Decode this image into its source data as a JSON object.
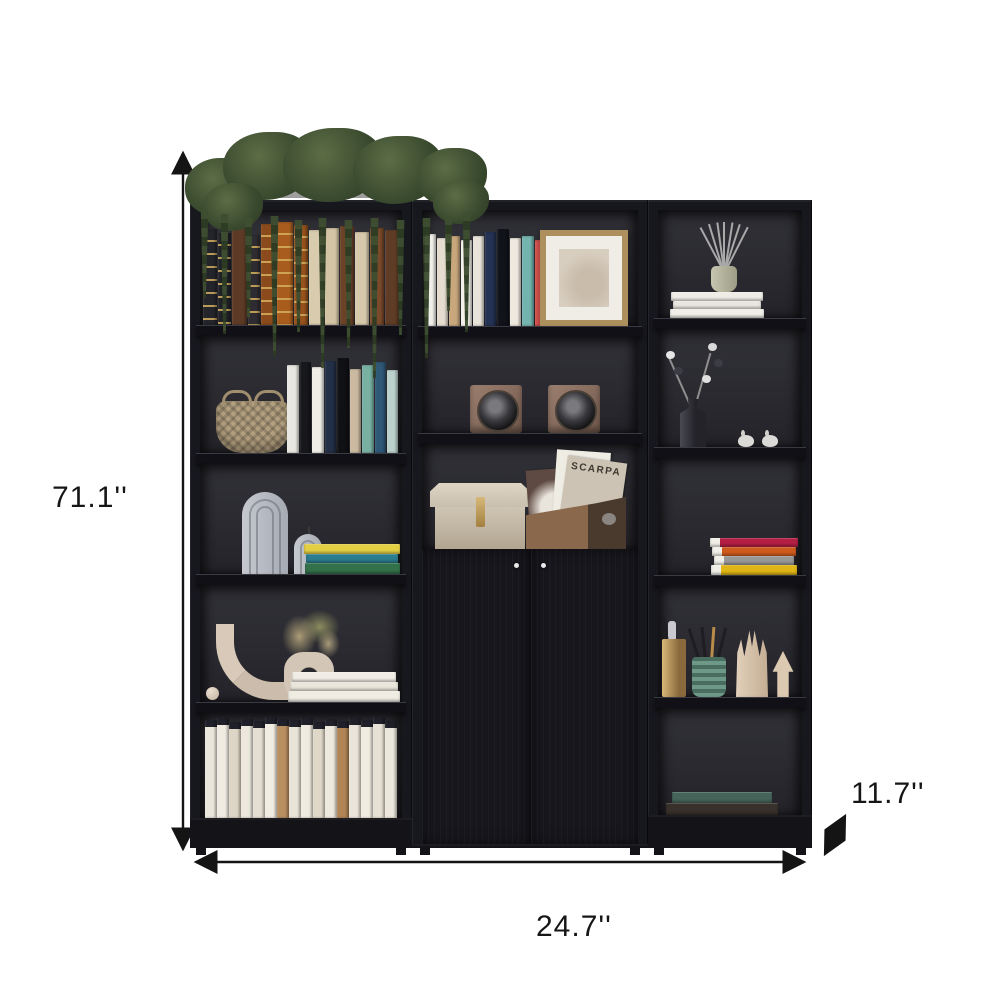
{
  "dimensions": {
    "height_label": "71.1''",
    "width_label": "24.7''",
    "depth_label": "11.7''"
  },
  "decor": {
    "magazine_label": "SCARPA"
  },
  "palette": {
    "background": "#ffffff",
    "frame": "#17171e",
    "interior": "#2b2b31",
    "shelf": "#101016",
    "annotation": "#161616",
    "planter": "#b9b9b9",
    "plant_green": "#44543a",
    "speaker_bronze": "#8d7468",
    "frame_gold": "#ad905e"
  },
  "books": {
    "left_row1": [
      {
        "c": "#23252b",
        "h": 96,
        "w": 14,
        "cls": "bands"
      },
      {
        "c": "#1f2127",
        "h": 92,
        "w": 13,
        "cls": "bands"
      },
      {
        "c": "#5d3a26",
        "h": 100,
        "w": 15
      },
      {
        "c": "#2e2c30",
        "h": 90,
        "w": 12,
        "cls": "bands"
      },
      {
        "c": "#8a4a1c",
        "h": 101,
        "w": 15,
        "cls": "bands"
      },
      {
        "c": "#a85c1e",
        "h": 103,
        "w": 16,
        "cls": "bands"
      },
      {
        "c": "#96521c",
        "h": 100,
        "w": 14,
        "cls": "bands"
      },
      {
        "c": "#d8cbae",
        "h": 95,
        "w": 15
      },
      {
        "c": "#d2c4a4",
        "h": 97,
        "w": 14
      },
      {
        "c": "#6b4227",
        "h": 99,
        "w": 14
      },
      {
        "c": "#d6c9ab",
        "h": 93,
        "w": 14
      },
      {
        "c": "#7a4a2a",
        "h": 97,
        "w": 14
      },
      {
        "c": "#5f3c25",
        "h": 95,
        "w": 14
      }
    ],
    "left_row2": [
      {
        "c": "#e9e7e1",
        "h": 88,
        "w": 12
      },
      {
        "c": "#17181c",
        "h": 91,
        "w": 11
      },
      {
        "c": "#f0ede6",
        "h": 86,
        "w": 12
      },
      {
        "c": "#233048",
        "h": 92,
        "w": 11
      },
      {
        "c": "#101114",
        "h": 95,
        "w": 12
      },
      {
        "c": "#cbb9a0",
        "h": 84,
        "w": 11
      },
      {
        "c": "#78b0a2",
        "h": 88,
        "w": 12
      },
      {
        "c": "#2f5877",
        "h": 91,
        "w": 11
      },
      {
        "c": "#bcd0cc",
        "h": 83,
        "w": 11
      }
    ],
    "left_row3_stack": [
      {
        "c": "#e3cf44",
        "h": 10,
        "w": 96
      },
      {
        "c": "#2c7d90",
        "h": 9,
        "w": 92
      },
      {
        "c": "#33714b",
        "h": 11,
        "w": 95
      }
    ],
    "left_row4_stack": [
      {
        "c": "#f0ede4",
        "h": 10,
        "w": 104
      },
      {
        "c": "#e9e5da",
        "h": 9,
        "w": 108
      },
      {
        "c": "#efece2",
        "h": 11,
        "w": 112
      }
    ],
    "left_row5": [
      {
        "c": "#eae6db",
        "h": 98,
        "w": 12,
        "cls": "dark-top"
      },
      {
        "c": "#f0ece2",
        "h": 100,
        "w": 12,
        "cls": "dark-top"
      },
      {
        "c": "#ddd5c5",
        "h": 96,
        "w": 12,
        "cls": "dark-top"
      },
      {
        "c": "#ece8dd",
        "h": 99,
        "w": 12,
        "cls": "dark-top"
      },
      {
        "c": "#e4dfd2",
        "h": 97,
        "w": 12,
        "cls": "dark-top"
      },
      {
        "c": "#f1ede3",
        "h": 101,
        "w": 12,
        "cls": "dark-top"
      },
      {
        "c": "#b98e60",
        "h": 99,
        "w": 12,
        "cls": "dark-top"
      },
      {
        "c": "#e9e4d8",
        "h": 98,
        "w": 12,
        "cls": "dark-top"
      },
      {
        "c": "#efebe0",
        "h": 100,
        "w": 12,
        "cls": "dark-top"
      },
      {
        "c": "#dfd8c8",
        "h": 96,
        "w": 12,
        "cls": "dark-top"
      },
      {
        "c": "#ede9de",
        "h": 99,
        "w": 12,
        "cls": "dark-top"
      },
      {
        "c": "#b08455",
        "h": 97,
        "w": 12,
        "cls": "dark-top"
      },
      {
        "c": "#eae5da",
        "h": 100,
        "w": 12,
        "cls": "dark-top"
      },
      {
        "c": "#f0ece1",
        "h": 98,
        "w": 12,
        "cls": "dark-top"
      },
      {
        "c": "#e6e1d4",
        "h": 101,
        "w": 12,
        "cls": "dark-top"
      },
      {
        "c": "#ece7dc",
        "h": 97,
        "w": 12,
        "cls": "dark-top"
      }
    ],
    "mid_row1": [
      {
        "c": "#f1efe9",
        "h": 92,
        "w": 11
      },
      {
        "c": "#e5ded0",
        "h": 88,
        "w": 11
      },
      {
        "c": "#c9a77c",
        "h": 90,
        "w": 11
      },
      {
        "c": "#f3f1ea",
        "h": 86,
        "w": 11
      },
      {
        "c": "#e8e4da",
        "h": 90,
        "w": 11
      },
      {
        "c": "#243254",
        "h": 94,
        "w": 11
      },
      {
        "c": "#11131a",
        "h": 97,
        "w": 12
      },
      {
        "c": "#eee9df",
        "h": 88,
        "w": 11
      },
      {
        "c": "#74b4af",
        "h": 90,
        "w": 12
      },
      {
        "c": "#d9534f",
        "h": 86,
        "w": 10
      },
      {
        "c": "#15161b",
        "h": 96,
        "w": 12
      }
    ],
    "right_row1_stack": [
      {
        "c": "#efece6",
        "h": 9,
        "w": 92
      },
      {
        "c": "#e9e6df",
        "h": 8,
        "w": 88
      },
      {
        "c": "#f1eee8",
        "h": 9,
        "w": 94
      }
    ],
    "right_row3_stack": [
      {
        "c": "#b21e44",
        "h": 9,
        "w": 88,
        "cls": "pages-left"
      },
      {
        "c": "#cf5a1d",
        "h": 9,
        "w": 84,
        "cls": "pages-left"
      },
      {
        "c": "#989898",
        "h": 9,
        "w": 80,
        "cls": "pages-left"
      },
      {
        "c": "#dfb517",
        "h": 10,
        "w": 86,
        "cls": "pages-left"
      }
    ],
    "right_row5_stack": [
      {
        "c": "#46645a",
        "h": 11,
        "w": 100,
        "cls": "pages-under"
      },
      {
        "c": "#38302b",
        "h": 12,
        "w": 112
      }
    ]
  }
}
